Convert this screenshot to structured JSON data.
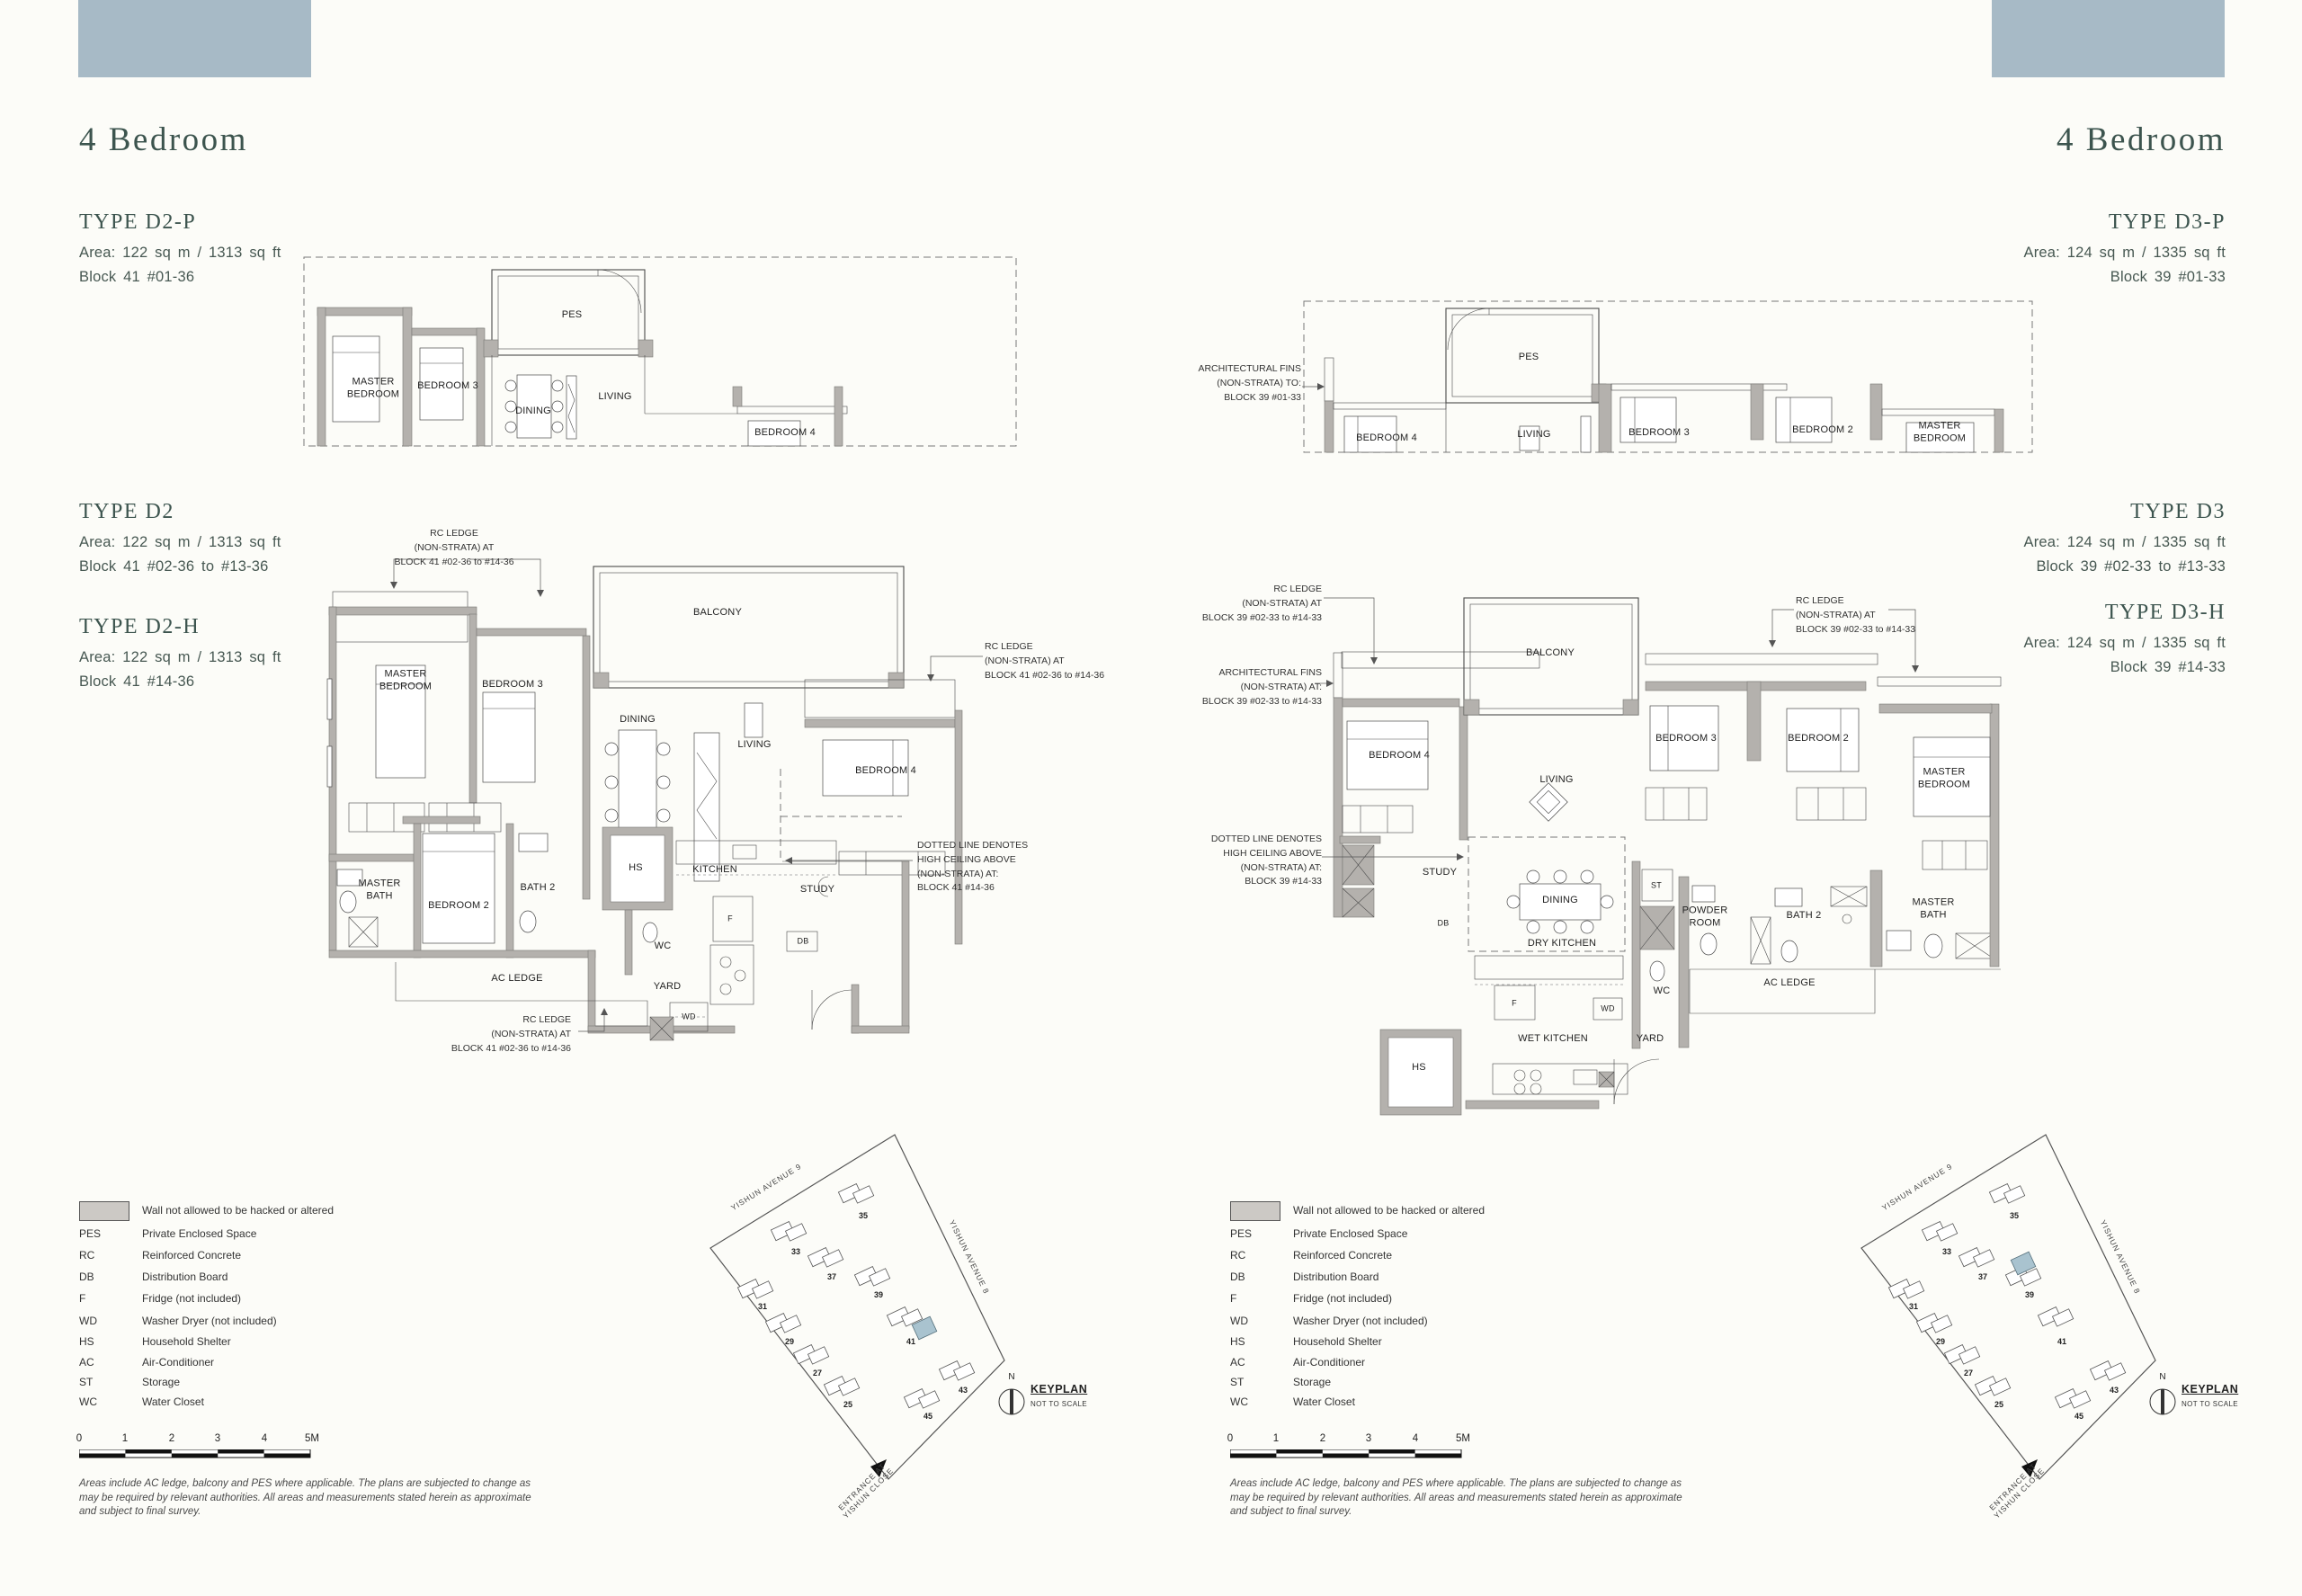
{
  "pages": {
    "left": {
      "heading": "4 Bedroom",
      "types": {
        "d2p": {
          "name": "TYPE D2-P",
          "area": "Area: 122 sq m / 1313 sq ft",
          "block": "Block 41 #01-36"
        },
        "d2": {
          "name": "TYPE D2",
          "area": "Area: 122 sq m / 1313 sq ft",
          "block": "Block 41 #02-36 to #13-36"
        },
        "d2h": {
          "name": "TYPE D2-H",
          "area": "Area: 122 sq m / 1313 sq ft",
          "block": "Block 41 #14-36"
        }
      }
    },
    "right": {
      "heading": "4 Bedroom",
      "types": {
        "d3p": {
          "name": "TYPE D3-P",
          "area": "Area: 124 sq m / 1335 sq ft",
          "block": "Block 39 #01-33"
        },
        "d3": {
          "name": "TYPE D3",
          "area": "Area: 124 sq m / 1335 sq ft",
          "block": "Block 39 #02-33 to #13-33"
        },
        "d3h": {
          "name": "TYPE D3-H",
          "area": "Area: 124 sq m / 1335 sq ft",
          "block": "Block 39 #14-33"
        }
      }
    }
  },
  "plans": {
    "d2p": {
      "rooms": {
        "master_bedroom": "MASTER\nBEDROOM",
        "bedroom3": "BEDROOM 3",
        "pes": "PES",
        "dining": "DINING",
        "living": "LIVING",
        "bedroom4": "BEDROOM 4"
      }
    },
    "d2": {
      "rooms": {
        "master_bedroom": "MASTER\nBEDROOM",
        "bedroom3": "BEDROOM 3",
        "balcony": "BALCONY",
        "dining": "DINING",
        "living": "LIVING",
        "bedroom4": "BEDROOM 4",
        "master_bath": "MASTER\nBATH",
        "bedroom2": "BEDROOM 2",
        "bath2": "BATH 2",
        "hs": "HS",
        "kitchen": "KITCHEN",
        "study": "STUDY",
        "wc": "WC",
        "yard": "YARD",
        "db": "DB",
        "f": "F",
        "wd": "WD"
      },
      "annotations": {
        "rc_ledge_top": "RC LEDGE\n(NON-STRATA) AT\nBLOCK 41 #02-36 to #14-36",
        "rc_ledge_right": "RC LEDGE\n(NON-STRATA) AT\nBLOCK 41 #02-36 to #14-36",
        "rc_ledge_bottom": "RC LEDGE\n(NON-STRATA) AT\nBLOCK 41 #02-36 to #14-36",
        "dotted_line": "DOTTED LINE DENOTES\nHIGH CEILING ABOVE\n(NON-STRATA) AT:\nBLOCK 41 #14-36",
        "ac_ledge": "AC LEDGE"
      }
    },
    "d3p": {
      "rooms": {
        "bedroom4": "BEDROOM 4",
        "pes": "PES",
        "living": "LIVING",
        "bedroom3": "BEDROOM 3",
        "bedroom2": "BEDROOM 2",
        "master_bedroom": "MASTER\nBEDROOM"
      },
      "annotations": {
        "arch_fins": "ARCHITECTURAL FINS\n(NON-STRATA) TO:\nBLOCK 39 #01-33"
      }
    },
    "d3": {
      "rooms": {
        "balcony": "BALCONY",
        "bedroom4": "BEDROOM 4",
        "living": "LIVING",
        "study": "STUDY",
        "dining": "DINING",
        "dry_kitchen": "DRY KITCHEN",
        "wet_kitchen": "WET KITCHEN",
        "yard": "YARD",
        "wc": "WC",
        "st": "ST",
        "powder_room": "POWDER\nROOM",
        "db": "DB",
        "f": "F",
        "wd": "WD",
        "hs": "HS",
        "bedroom3": "BEDROOM 3",
        "bedroom2": "BEDROOM 2",
        "master_bedroom": "MASTER\nBEDROOM",
        "bath2": "BATH 2",
        "master_bath": "MASTER\nBATH"
      },
      "annotations": {
        "rc_ledge_left": "RC LEDGE\n(NON-STRATA) AT\nBLOCK 39 #02-33 to #14-33",
        "arch_fins": "ARCHITECTURAL FINS\n(NON-STRATA) AT:\nBLOCK 39 #02-33 to #14-33",
        "dotted_line": "DOTTED LINE DENOTES\nHIGH CEILING ABOVE\n(NON-STRATA) AT:\nBLOCK 39 #14-33",
        "rc_ledge_top": "RC LEDGE\n(NON-STRATA) AT\nBLOCK 39 #02-33 to #14-33",
        "ac_ledge": "AC LEDGE"
      }
    }
  },
  "legend": {
    "wall_note": "Wall not allowed to be hacked or altered",
    "items": [
      [
        "PES",
        "Private Enclosed Space"
      ],
      [
        "RC",
        "Reinforced Concrete"
      ],
      [
        "DB",
        "Distribution Board"
      ],
      [
        "F",
        "Fridge (not included)"
      ],
      [
        "WD",
        "Washer Dryer (not included)"
      ],
      [
        "HS",
        "Household Shelter"
      ],
      [
        "AC",
        "Air-Conditioner"
      ],
      [
        "ST",
        "Storage"
      ],
      [
        "WC",
        "Water Closet"
      ]
    ]
  },
  "scalebar": {
    "ticks": [
      "0",
      "1",
      "2",
      "3",
      "4",
      "5M"
    ]
  },
  "keyplan": {
    "title": "KEYPLAN",
    "subtitle": "NOT TO SCALE",
    "north": "N",
    "avenue9": "YISHUN AVENUE 9",
    "avenue8": "YISHUN AVENUE 8",
    "entrance": "ENTRANCE AT\nYISHUN CLOSE",
    "blocks": [
      "25",
      "27",
      "29",
      "31",
      "33",
      "35",
      "37",
      "39",
      "41",
      "43",
      "45"
    ]
  },
  "disclaimer": "Areas include AC ledge, balcony and PES where applicable. The plans are subjected to change as\nmay be required by relevant authorities. All areas and measurements stated herein as approximate\nand subject to final survey.",
  "colors": {
    "deco_rect": "#a7bac6",
    "heading_text": "#3c544e",
    "wall_gray": "#b4b1ad",
    "keyplan_highlight": "#a9c3cf",
    "background": "#fcfcf8"
  }
}
